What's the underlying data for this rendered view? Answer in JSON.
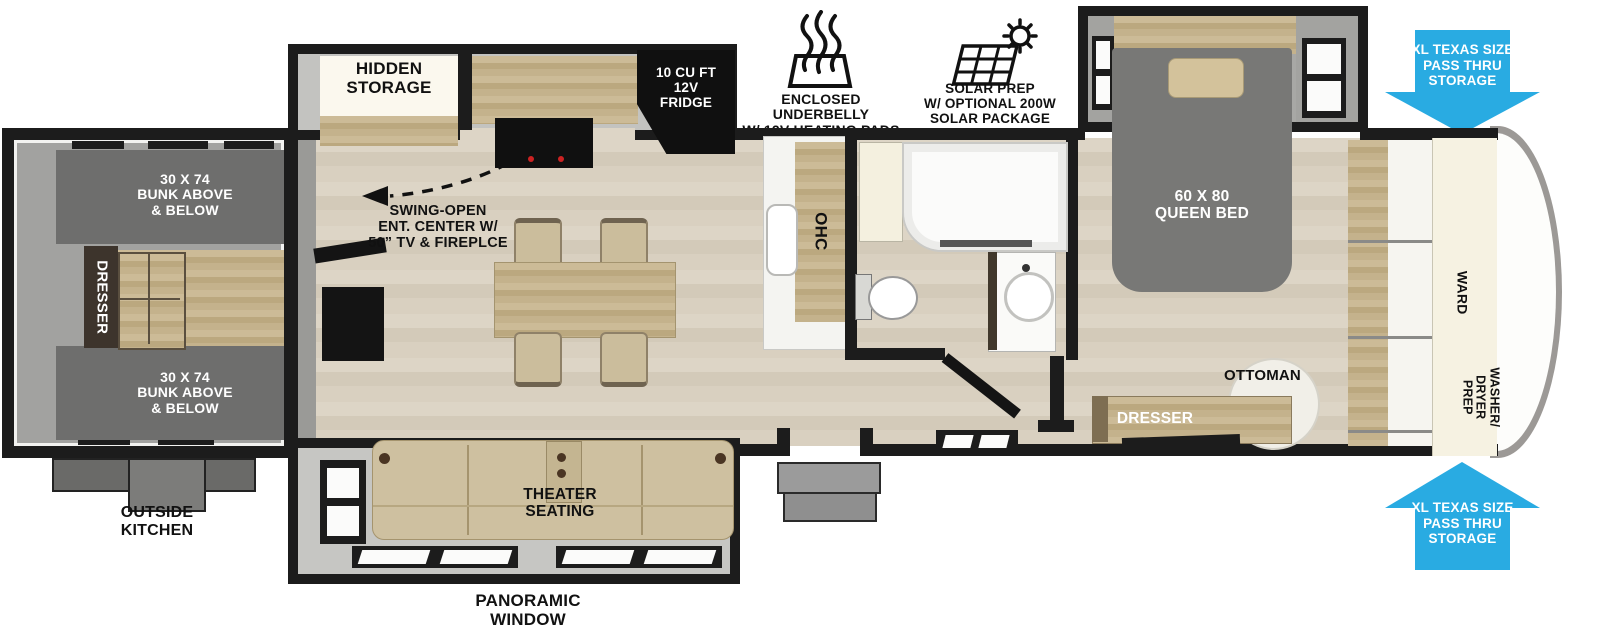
{
  "features": {
    "underbelly": {
      "icon": "heating-waves-icon",
      "label": "ENCLOSED UNDERBELLY\nW/ 12V HEATING PADS"
    },
    "solar": {
      "icon": "solar-panel-sun-icon",
      "label": "SOLAR PREP\nW/ OPTIONAL 200W\nSOLAR PACKAGE"
    }
  },
  "storage_arrows": {
    "color": "#29abe2",
    "top": "XL TEXAS SIZE\nPASS THRU\nSTORAGE",
    "bottom": "XL TEXAS SIZE\nPASS THRU\nSTORAGE"
  },
  "bunk_room": {
    "bunk_top": "30 X 74\nBUNK ABOVE\n& BELOW",
    "bunk_bottom": "30 X 74\nBUNK ABOVE\n& BELOW",
    "dresser": "DRESSER",
    "outside_kitchen": "OUTSIDE\nKITCHEN"
  },
  "kitchen": {
    "hidden_storage": "HIDDEN\nSTORAGE",
    "fridge": "10 CU FT\n12V\nFRIDGE",
    "ohc": "OHC",
    "ent_center": "SWING-OPEN\nENT. CENTER W/\n50” TV & FIREPLCE"
  },
  "living": {
    "theater": "THEATER\nSEATING",
    "panoramic": "PANORAMIC\nWINDOW"
  },
  "bedroom": {
    "bed": "60 X 80\nQUEEN BED",
    "ottoman": "OTTOMAN",
    "dresser": "DRESSER",
    "ward": "WARD",
    "washer_dryer": "WASHER/\nDRYER\nPREP"
  }
}
